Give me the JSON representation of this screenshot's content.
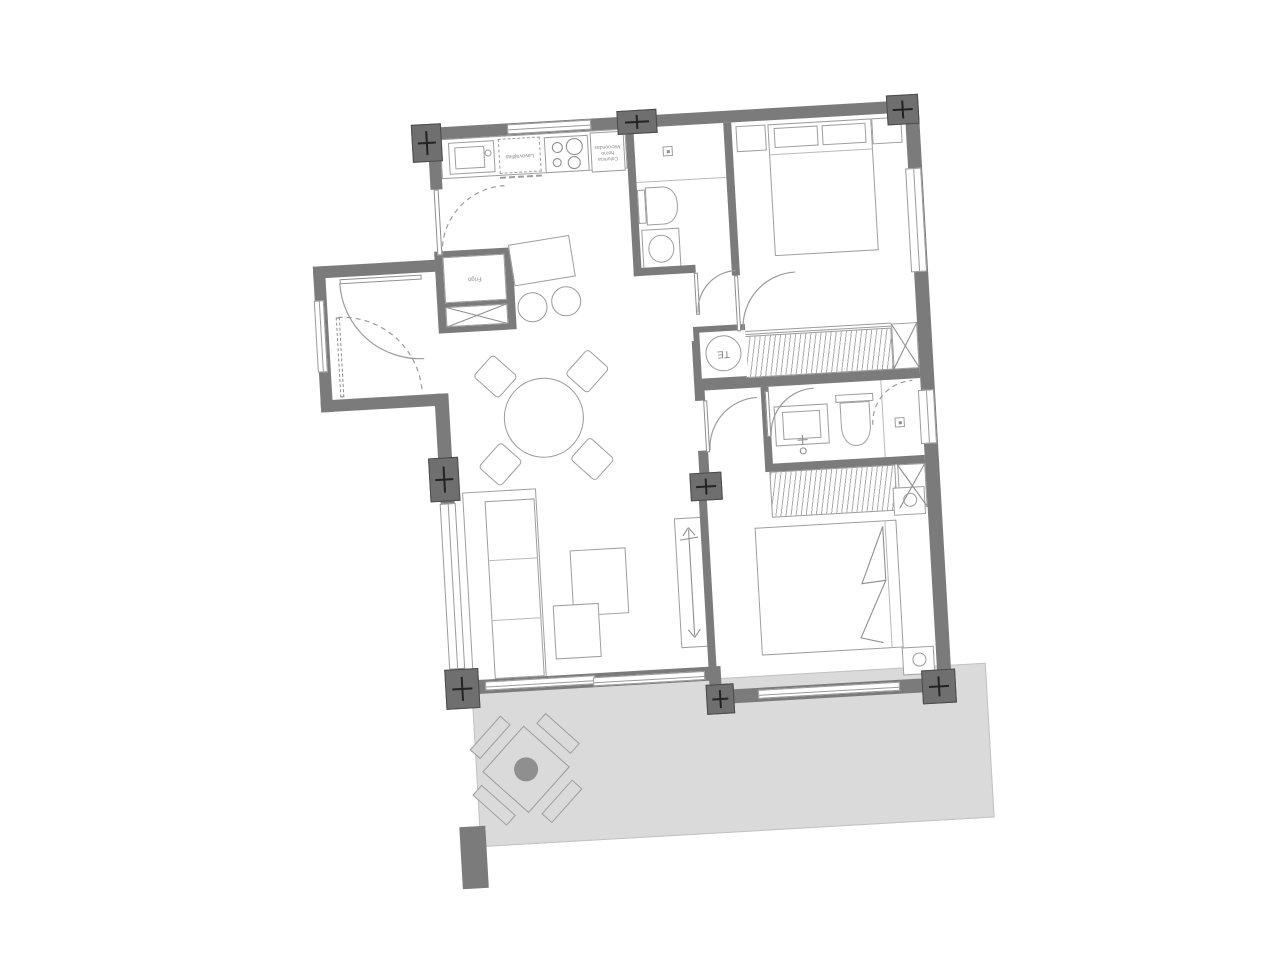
{
  "plan": {
    "type": "apartment-floor-plan",
    "labels": {
      "dishwasher": "Lavavajillas",
      "column_1": "Columna",
      "column_2": "horno",
      "column_3": "Microondas",
      "fridge": "Frigo",
      "water_heater": "TE"
    },
    "colors": {
      "wall": "#7b7b7b",
      "pillar": "#6f6f6f",
      "terrace_fill": "#dadada",
      "furniture_line": "#9e9e9e",
      "hatch_line": "#adadad"
    },
    "rooms": [
      "kitchen",
      "entrance-vestibule",
      "living-dining",
      "hallway",
      "bathroom-1",
      "bedroom-1",
      "hallway-2",
      "bathroom-2",
      "bedroom-2",
      "terrace"
    ]
  }
}
